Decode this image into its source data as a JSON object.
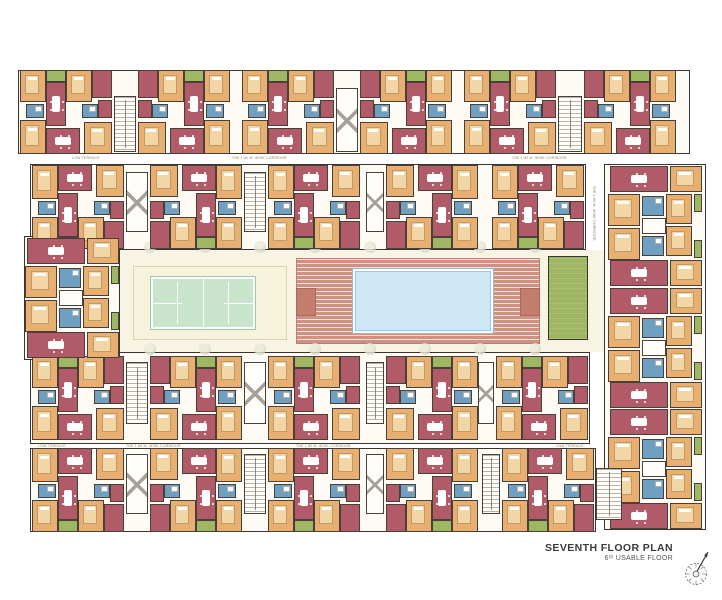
{
  "title": {
    "line1": "SEVENTH FLOOR PLAN",
    "line2": "6ᵗʰ USABLE FLOOR"
  },
  "labels": {
    "corridor": "THE 1.80 M. WIDE CORRIDOR",
    "terrace": "LOW TERRACE"
  },
  "palette": {
    "living": "#b15a68",
    "bedroom": "#e9af70",
    "toilet": "#6fa0c2",
    "balcony": "#9fb763",
    "wall": "#4a403a",
    "wing_bg": "#fdfbf4",
    "ground": "#f8f4e4",
    "tennis": "#c8e5cb",
    "deck": "#cf9181",
    "pool": "#cde7f5",
    "green_room": "#9fb763",
    "label_text": "#8f7f56",
    "title_text": "#3b3b3b"
  },
  "amenities": {
    "tennis": "tennis-court",
    "pool": "swimming-pool",
    "deck": "pool-deck",
    "lawn": "green-room"
  },
  "plan": {
    "wings": [
      {
        "name": "wing-top",
        "x": 18,
        "y": 70,
        "w": 672,
        "h": 84
      },
      {
        "name": "wing-upper-middle",
        "x": 30,
        "y": 164,
        "w": 556,
        "h": 86
      },
      {
        "name": "wing-lower-middle",
        "x": 30,
        "y": 352,
        "w": 560,
        "h": 92
      },
      {
        "name": "wing-bottom",
        "x": 30,
        "y": 448,
        "w": 566,
        "h": 84
      },
      {
        "name": "tower-left",
        "x": 24,
        "y": 236,
        "w": 96,
        "h": 124
      },
      {
        "name": "tower-right",
        "x": 604,
        "y": 164,
        "w": 102,
        "h": 366
      }
    ],
    "archetypes": {
      "H": {
        "w": 92,
        "h": 84,
        "rooms": [
          [
            0,
            0,
            26,
            32,
            "bed",
            "bed"
          ],
          [
            26,
            0,
            20,
            12,
            "balc",
            null
          ],
          [
            26,
            12,
            20,
            44,
            "liv",
            "table"
          ],
          [
            46,
            0,
            26,
            32,
            "bed",
            "bed"
          ],
          [
            72,
            0,
            20,
            28,
            "liv",
            null
          ],
          [
            6,
            34,
            18,
            14,
            "wc",
            "fix"
          ],
          [
            0,
            50,
            26,
            34,
            "bed",
            "bed"
          ],
          [
            26,
            58,
            34,
            26,
            "liv",
            "table"
          ],
          [
            62,
            34,
            16,
            14,
            "wc",
            "fix"
          ],
          [
            64,
            52,
            28,
            32,
            "bed",
            "bed"
          ],
          [
            78,
            30,
            14,
            18,
            "liv",
            null
          ]
        ]
      },
      "V": {
        "w": 94,
        "h": 120,
        "rooms": [
          [
            2,
            0,
            58,
            26,
            "liv",
            "table"
          ],
          [
            62,
            0,
            32,
            26,
            "bed",
            "bed"
          ],
          [
            86,
            28,
            8,
            18,
            "balc",
            null
          ],
          [
            0,
            28,
            32,
            32,
            "bed",
            "bed"
          ],
          [
            34,
            30,
            22,
            20,
            "wc",
            "fix"
          ],
          [
            58,
            28,
            26,
            30,
            "bed",
            "bed"
          ],
          [
            34,
            52,
            24,
            16,
            "core",
            null
          ],
          [
            34,
            70,
            22,
            20,
            "wc",
            "fix"
          ],
          [
            0,
            62,
            32,
            32,
            "bed",
            "bed"
          ],
          [
            58,
            60,
            26,
            30,
            "bed",
            "bed"
          ],
          [
            2,
            94,
            58,
            26,
            "liv",
            "table"
          ],
          [
            62,
            94,
            32,
            26,
            "bed",
            "bed"
          ],
          [
            86,
            74,
            8,
            18,
            "balc",
            null
          ]
        ]
      }
    },
    "clusters": [
      [
        "H",
        20,
        70,
        0,
        0
      ],
      [
        "H",
        138,
        70,
        1,
        0
      ],
      [
        "H",
        242,
        70,
        0,
        0
      ],
      [
        "H",
        360,
        70,
        1,
        0
      ],
      [
        "H",
        464,
        70,
        0,
        0
      ],
      [
        "H",
        584,
        70,
        1,
        0
      ],
      [
        "H",
        32,
        165,
        0,
        1
      ],
      [
        "H",
        150,
        165,
        1,
        1
      ],
      [
        "H",
        268,
        165,
        0,
        1
      ],
      [
        "H",
        386,
        165,
        1,
        1
      ],
      [
        "H",
        492,
        165,
        0,
        1
      ],
      [
        "H",
        32,
        356,
        0,
        0
      ],
      [
        "H",
        150,
        356,
        1,
        0
      ],
      [
        "H",
        268,
        356,
        0,
        0
      ],
      [
        "H",
        386,
        356,
        1,
        0
      ],
      [
        "H",
        496,
        356,
        0,
        0
      ],
      [
        "H",
        32,
        448,
        0,
        1
      ],
      [
        "H",
        150,
        448,
        1,
        1
      ],
      [
        "H",
        268,
        448,
        0,
        1
      ],
      [
        "H",
        386,
        448,
        1,
        1
      ],
      [
        "H",
        502,
        448,
        0,
        1
      ],
      [
        "V",
        25,
        238,
        0,
        0
      ],
      [
        "V",
        608,
        166,
        0,
        0
      ],
      [
        "V",
        608,
        288,
        0,
        0
      ],
      [
        "V",
        608,
        409,
        0,
        0
      ]
    ],
    "cores": [
      [
        114,
        96,
        22,
        56,
        "stair"
      ],
      [
        336,
        88,
        22,
        64,
        "lift"
      ],
      [
        558,
        96,
        24,
        56,
        "stair"
      ],
      [
        126,
        172,
        22,
        60,
        "lift"
      ],
      [
        244,
        172,
        22,
        60,
        "stair"
      ],
      [
        366,
        172,
        18,
        60,
        "lift"
      ],
      [
        126,
        362,
        22,
        62,
        "stair"
      ],
      [
        244,
        362,
        22,
        62,
        "lift"
      ],
      [
        366,
        362,
        18,
        62,
        "stair"
      ],
      [
        478,
        362,
        16,
        62,
        "lift"
      ],
      [
        126,
        454,
        22,
        60,
        "lift"
      ],
      [
        244,
        454,
        22,
        60,
        "stair"
      ],
      [
        366,
        454,
        18,
        60,
        "lift"
      ],
      [
        482,
        454,
        18,
        60,
        "stair"
      ],
      [
        596,
        468,
        26,
        52,
        "stair"
      ]
    ],
    "courtyard": {
      "ground": {
        "x": 120,
        "y": 250,
        "w": 484,
        "h": 102
      },
      "tennis_panel": {
        "x": 133,
        "y": 266,
        "w": 152,
        "h": 72
      },
      "tennis_court": {
        "x": 150,
        "y": 276,
        "w": 104,
        "h": 52
      },
      "deck": {
        "x": 296,
        "y": 258,
        "w": 242,
        "h": 84
      },
      "deck_tabs": [
        {
          "x": 296,
          "y": 288,
          "w": 18,
          "h": 26
        },
        {
          "x": 520,
          "y": 288,
          "w": 18,
          "h": 26
        }
      ],
      "pool": {
        "x": 352,
        "y": 268,
        "w": 140,
        "h": 64
      },
      "green_room": {
        "x": 548,
        "y": 256,
        "w": 38,
        "h": 82
      }
    },
    "planters": {
      "rows": [
        247,
        349
      ],
      "xs": [
        150,
        205,
        260,
        315,
        370,
        425,
        480,
        535
      ]
    },
    "plan_labels": [
      [
        72,
        156,
        "terrace",
        0
      ],
      [
        232,
        156,
        "corridor",
        0
      ],
      [
        512,
        156,
        "corridor",
        0
      ],
      [
        38,
        444,
        "terrace",
        0
      ],
      [
        126,
        444,
        "corridor",
        0
      ],
      [
        296,
        444,
        "corridor",
        0
      ],
      [
        556,
        444,
        "terrace",
        0
      ],
      [
        596,
        186,
        "corridor",
        1
      ]
    ]
  }
}
